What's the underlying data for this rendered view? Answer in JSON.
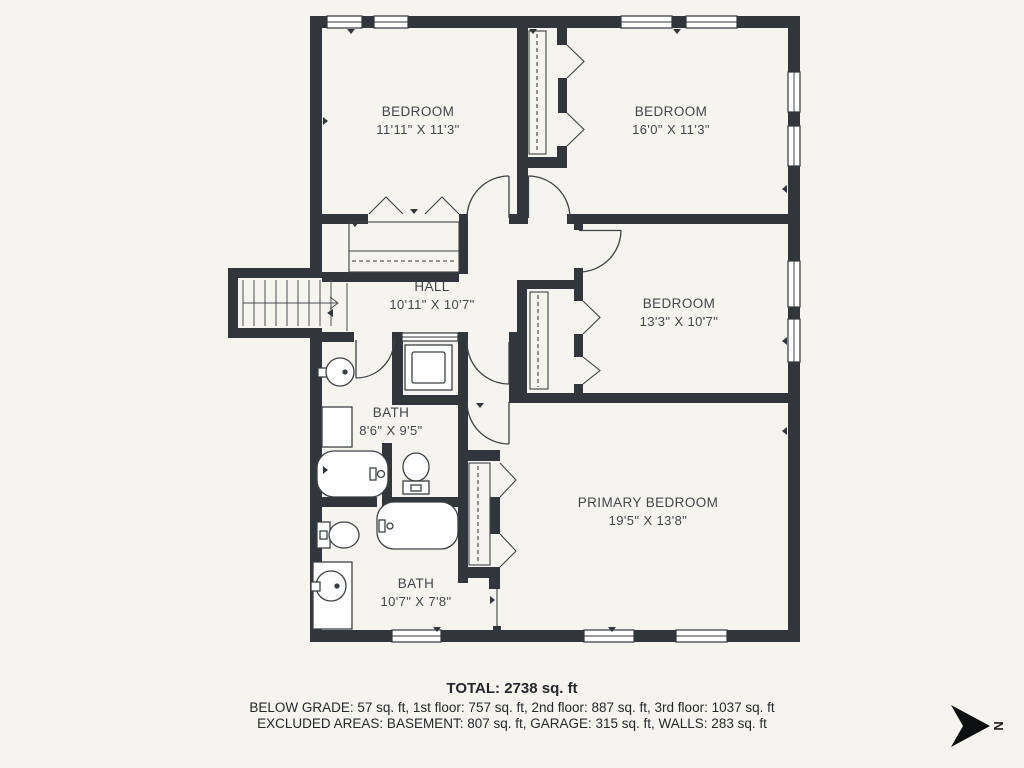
{
  "rooms": [
    {
      "id": "bedroom-1",
      "name": "BEDROOM",
      "dims": "11'11\" X 11'3\""
    },
    {
      "id": "bedroom-2",
      "name": "BEDROOM",
      "dims": "16'0\" X 11'3\""
    },
    {
      "id": "hall",
      "name": "HALL",
      "dims": "10'11\" X 10'7\""
    },
    {
      "id": "bedroom-3",
      "name": "BEDROOM",
      "dims": "13'3\" X 10'7\""
    },
    {
      "id": "bath-1",
      "name": "BATH",
      "dims": "8'6\" X 9'5\""
    },
    {
      "id": "primary-bedroom",
      "name": "PRIMARY BEDROOM",
      "dims": "19'5\" X 13'8\""
    },
    {
      "id": "bath-2",
      "name": "BATH",
      "dims": "10'7\" X 7'8\""
    }
  ],
  "footer": {
    "total": "TOTAL: 2738 sq. ft",
    "line1": "BELOW GRADE: 57 sq. ft, 1st floor: 757 sq. ft, 2nd floor: 887 sq. ft, 3rd floor: 1037 sq. ft",
    "line2": "EXCLUDED AREAS: BASEMENT: 807 sq. ft, GARAGE: 315 sq. ft, WALLS: 283 sq. ft"
  },
  "compass": {
    "label": "N"
  },
  "colors": {
    "wall": "#31363c",
    "background": "#f5f4ee",
    "line": "#3c4146",
    "text": "#42474c"
  }
}
